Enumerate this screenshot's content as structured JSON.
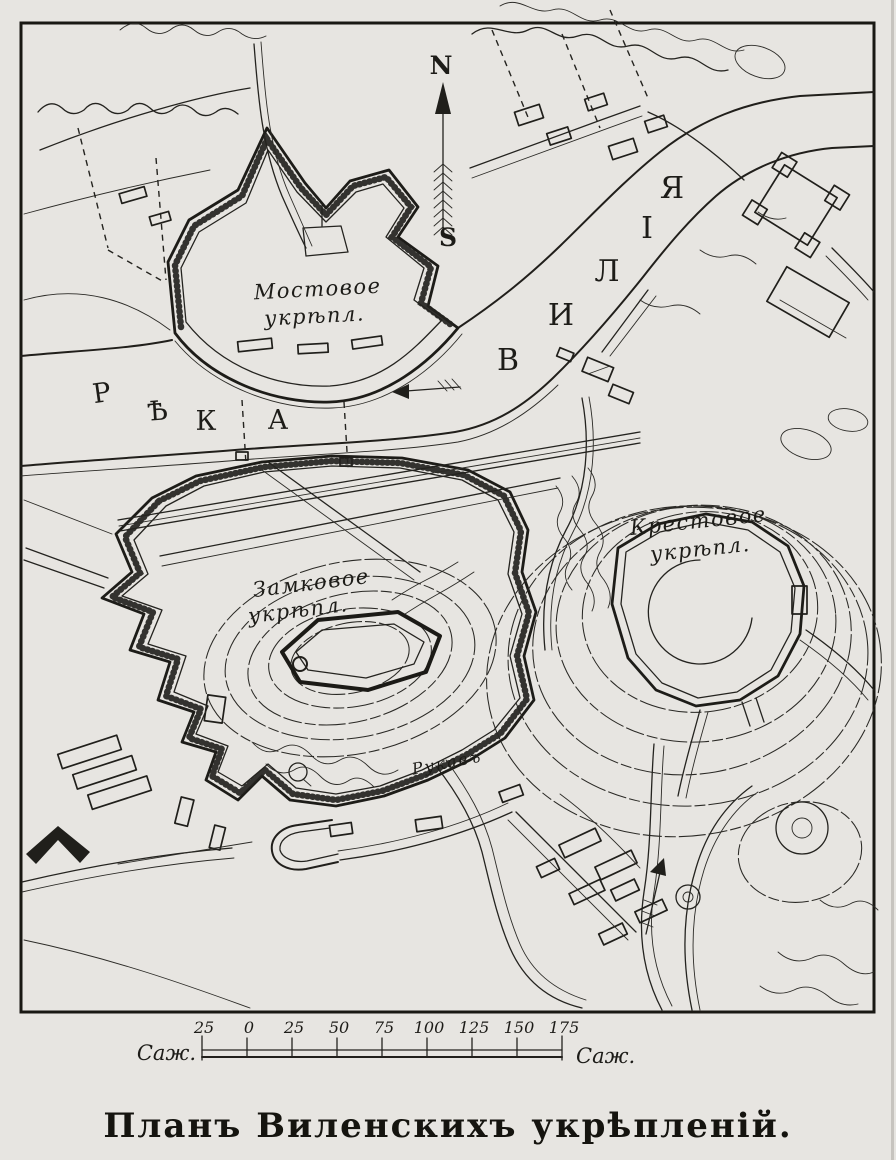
{
  "page": {
    "title": "Планъ Виленскихъ укрѣпленій."
  },
  "colors": {
    "paper": "#e7e5e1",
    "ink": "#22211d"
  },
  "compass": {
    "north": "N",
    "south": "S"
  },
  "river": {
    "name_left": "РѢКА",
    "letters_left": [
      "Р",
      "Ѣ",
      "К",
      "А"
    ],
    "name_right": "ВИЛІЯ",
    "letters_right": [
      "В",
      "И",
      "Л",
      "І",
      "Я"
    ]
  },
  "forts": {
    "bridge": {
      "line1": "Мостовое",
      "line2": "укрѣпл."
    },
    "castle": {
      "line1": "Замковое",
      "line2": "укрѣпл."
    },
    "cross": {
      "line1": "Крестовое",
      "line2": "укрѣпл."
    }
  },
  "stream_label": "Рукавъ",
  "scale": {
    "unit_left": "Саж.",
    "unit_right": "Саж.",
    "ticks": [
      "25",
      "0",
      "25",
      "50",
      "75",
      "100",
      "125",
      "150",
      "175"
    ]
  }
}
